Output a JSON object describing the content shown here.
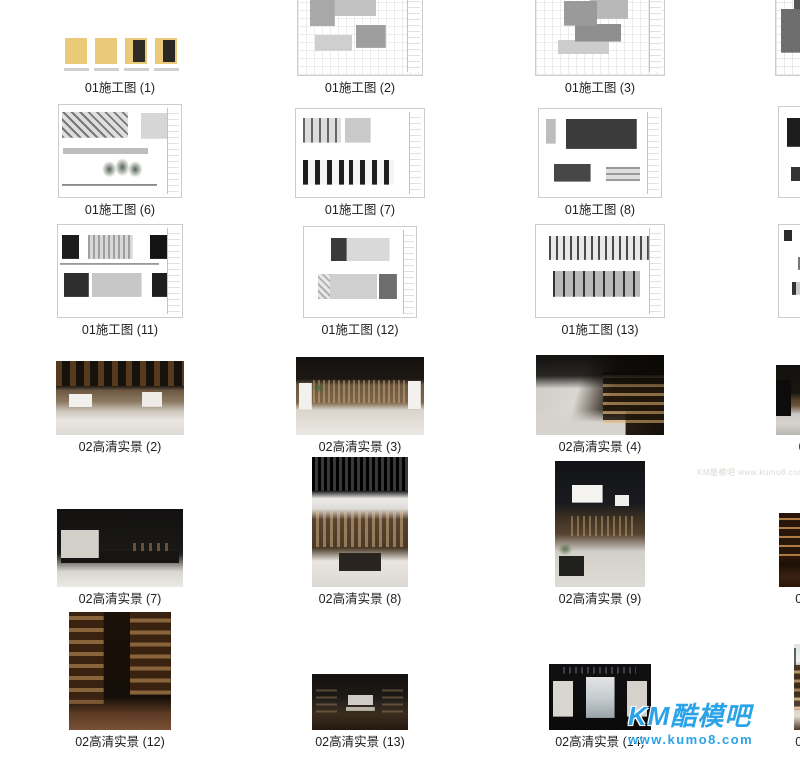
{
  "gallery": {
    "items": [
      {
        "label": "01施工图 (1)",
        "kind": "dwg-file-icons"
      },
      {
        "label": "01施工图 (2)",
        "kind": "cad-floor-plan"
      },
      {
        "label": "01施工图 (3)",
        "kind": "cad-floor-plan"
      },
      {
        "label": "01施工图 (4)",
        "kind": "cad-floor-plan-dark"
      },
      {
        "label": "01施工图 (5)",
        "kind": "cad-floor-plan-pink"
      },
      {
        "label": "01施工图 (6)",
        "kind": "cad-elevation-trees"
      },
      {
        "label": "01施工图 (7)",
        "kind": "cad-elevation-panels"
      },
      {
        "label": "01施工图 (8)",
        "kind": "cad-elevation-dark-panel"
      },
      {
        "label": "01施工图 (9)",
        "kind": "cad-elevation-black-panel"
      },
      {
        "label": "01施工图 (10)",
        "kind": "cad-elevation-bars"
      },
      {
        "label": "01施工图 (11)",
        "kind": "cad-elevation-strips"
      },
      {
        "label": "01施工图 (12)",
        "kind": "cad-elevation-strips"
      },
      {
        "label": "01施工图 (13)",
        "kind": "cad-elevation-lines"
      },
      {
        "label": "01施工图 (14)",
        "kind": "cad-elevation-mixed"
      },
      {
        "label": "02高清实景 (1)",
        "kind": "photo-dark-counter"
      },
      {
        "label": "02高清实景 (2)",
        "kind": "photo-bookstore-hall"
      },
      {
        "label": "02高清实景 (3)",
        "kind": "photo-shelf-wall"
      },
      {
        "label": "02高清实景 (4)",
        "kind": "photo-aisle-perspective"
      },
      {
        "label": "02高清实景 (5)",
        "kind": "photo-counter-shelves"
      },
      {
        "label": "02高清实景 (6)",
        "kind": "photo-dark-panorama"
      },
      {
        "label": "02高清实景 (7)",
        "kind": "photo-window-railing"
      },
      {
        "label": "02高清实景 (8)",
        "kind": "photo-portrait-slat-ceiling"
      },
      {
        "label": "02高清实景 (9)",
        "kind": "photo-portrait-lamps"
      },
      {
        "label": "02高清实景 (10)",
        "kind": "photo-warm-library"
      },
      {
        "label": "02高清实景 (11)",
        "kind": "photo-warm-lounge"
      },
      {
        "label": "02高清实景 (12)",
        "kind": "photo-portrait-shelves"
      },
      {
        "label": "02高清实景 (13)",
        "kind": "photo-dark-reading-room"
      },
      {
        "label": "02高清实景 (14)",
        "kind": "photo-window-mural"
      },
      {
        "label": "02高清实景 (15)",
        "kind": "photo-glass-ceiling"
      },
      {
        "label": "02高清实景 (16)",
        "kind": "photo-shelf-aisle"
      }
    ]
  },
  "watermarks": {
    "corner": {
      "title": "KM酷模吧",
      "url": "www.kumo8.com",
      "color": "#2ba3e8"
    },
    "faint": {
      "text": "KM酷模吧 www.kumo8.com"
    }
  }
}
